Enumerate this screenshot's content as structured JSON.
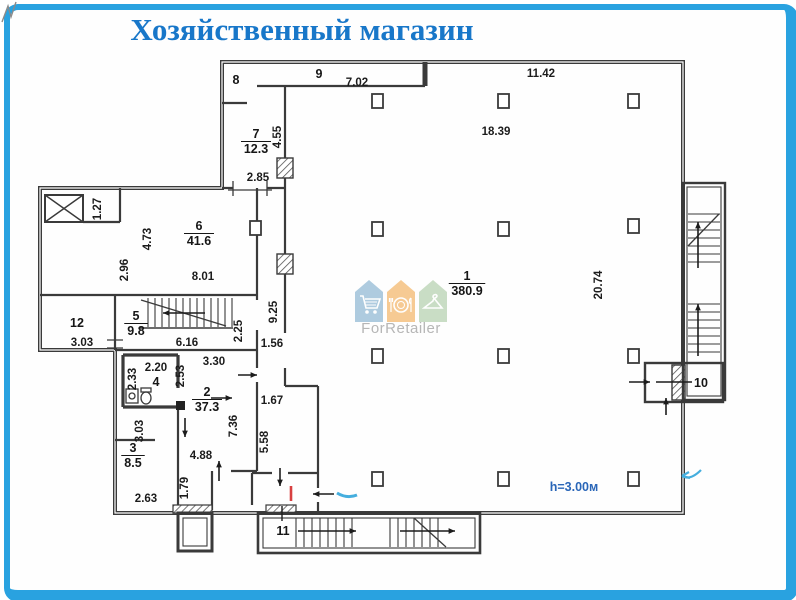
{
  "title": "Хозяйственный магазин",
  "colors": {
    "frame": "#29a2e0",
    "title": "#1877c9",
    "walls": "#3a3a3a",
    "red_mark": "#d84040",
    "blue_mark": "#45aede",
    "height_note": "#2a66b8",
    "logo_text": "#b3b3b3"
  },
  "logo": {
    "brand": "ForRetailer",
    "houses": [
      {
        "name": "cart-icon",
        "color": "#aac9de"
      },
      {
        "name": "dining-icon",
        "color": "#f6c88e"
      },
      {
        "name": "hanger-icon",
        "color": "#c7dcc3"
      }
    ]
  },
  "plan": {
    "height_note": {
      "text": "h=3.00м",
      "x": 574,
      "y": 491
    },
    "rooms": [
      {
        "num": "1",
        "area": "380.9",
        "x": 467,
        "y": 280
      },
      {
        "num": "2",
        "area": "37.3",
        "x": 207,
        "y": 396
      },
      {
        "num": "3",
        "area": "8.5",
        "x": 133,
        "y": 452
      },
      {
        "num": "4",
        "area": "",
        "x": 156,
        "y": 386
      },
      {
        "num": "5",
        "area": "9.8",
        "x": 136,
        "y": 320
      },
      {
        "num": "6",
        "area": "41.6",
        "x": 199,
        "y": 230
      },
      {
        "num": "7",
        "area": "12.3",
        "x": 256,
        "y": 138
      },
      {
        "num": "8",
        "area": "",
        "x": 236,
        "y": 84
      },
      {
        "num": "9",
        "area": "",
        "x": 319,
        "y": 78
      },
      {
        "num": "10",
        "area": "",
        "x": 701,
        "y": 387
      },
      {
        "num": "11",
        "area": "",
        "x": 283,
        "y": 535
      },
      {
        "num": "12",
        "area": "",
        "x": 77,
        "y": 327
      }
    ],
    "dimensions": [
      {
        "t": "7.02",
        "x": 357,
        "y": 86,
        "r": 0
      },
      {
        "t": "11.42",
        "x": 541,
        "y": 77,
        "r": 0
      },
      {
        "t": "18.39",
        "x": 496,
        "y": 135,
        "r": 0
      },
      {
        "t": "4.55",
        "x": 281,
        "y": 137,
        "r": -90
      },
      {
        "t": "2.85",
        "x": 258,
        "y": 181,
        "r": 0
      },
      {
        "t": "1.27",
        "x": 101,
        "y": 209,
        "r": -90
      },
      {
        "t": "4.73",
        "x": 151,
        "y": 239,
        "r": -90
      },
      {
        "t": "2.96",
        "x": 128,
        "y": 270,
        "r": -90
      },
      {
        "t": "8.01",
        "x": 203,
        "y": 280,
        "r": 0
      },
      {
        "t": "9.25",
        "x": 277,
        "y": 312,
        "r": -90
      },
      {
        "t": "2.25",
        "x": 242,
        "y": 331,
        "r": -90
      },
      {
        "t": "6.16",
        "x": 187,
        "y": 346,
        "r": 0
      },
      {
        "t": "1.56",
        "x": 272,
        "y": 347,
        "r": 0
      },
      {
        "t": "3.03",
        "x": 82,
        "y": 346,
        "r": 0
      },
      {
        "t": "3.30",
        "x": 214,
        "y": 365,
        "r": 0
      },
      {
        "t": "2.20",
        "x": 156,
        "y": 371,
        "r": 0
      },
      {
        "t": "2.33",
        "x": 136,
        "y": 379,
        "r": -90
      },
      {
        "t": "2.53",
        "x": 184,
        "y": 376,
        "r": -90
      },
      {
        "t": "1.67",
        "x": 272,
        "y": 404,
        "r": 0
      },
      {
        "t": "7.36",
        "x": 237,
        "y": 426,
        "r": -90
      },
      {
        "t": "3.03",
        "x": 143,
        "y": 431,
        "r": -90
      },
      {
        "t": "5.58",
        "x": 268,
        "y": 442,
        "r": -90
      },
      {
        "t": "4.88",
        "x": 201,
        "y": 459,
        "r": 0
      },
      {
        "t": "1.79",
        "x": 188,
        "y": 488,
        "r": -90
      },
      {
        "t": "2.63",
        "x": 146,
        "y": 502,
        "r": 0
      },
      {
        "t": "20.74",
        "x": 602,
        "y": 285,
        "r": -90
      }
    ]
  }
}
